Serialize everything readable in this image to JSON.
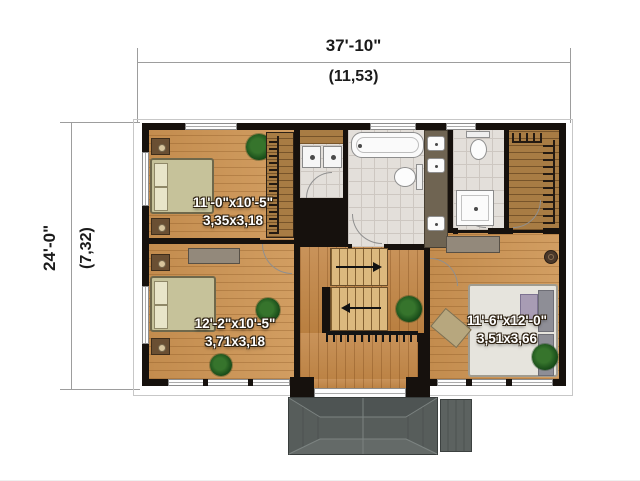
{
  "title": "second-floor-plan",
  "dimensions": {
    "width": {
      "imperial": "37'-10\"",
      "metric": "(11,53)"
    },
    "height": {
      "imperial": "24'-0\"",
      "metric": "(7,32)"
    }
  },
  "rooms": [
    {
      "name": "bedroom-top-left",
      "size_imperial": "11'-0\"x10'-5\"",
      "size_metric": "3,35x3,18"
    },
    {
      "name": "bedroom-bottom-left",
      "size_imperial": "12'-2\"x10'-5\"",
      "size_metric": "3,71x3,18"
    },
    {
      "name": "bedroom-right",
      "size_imperial": "11'-6\"x12'-0\"",
      "size_metric": "3,51x3,66"
    }
  ],
  "features": [
    "bathtub",
    "toilet",
    "double-sink-vanity",
    "shower",
    "washer-dryer",
    "walk-in-closet",
    "staircase",
    "porch-roof"
  ],
  "colors": {
    "wall": "#16110d",
    "wood_floor": "#c9955a",
    "hall_floor": "#bd8545",
    "tile_floor": "#e3dfda",
    "closet_floor": "#a87c44",
    "stair_tread": "#dcb97e",
    "roof": "#575d5b",
    "annotation_text": "#1b1b1b"
  }
}
